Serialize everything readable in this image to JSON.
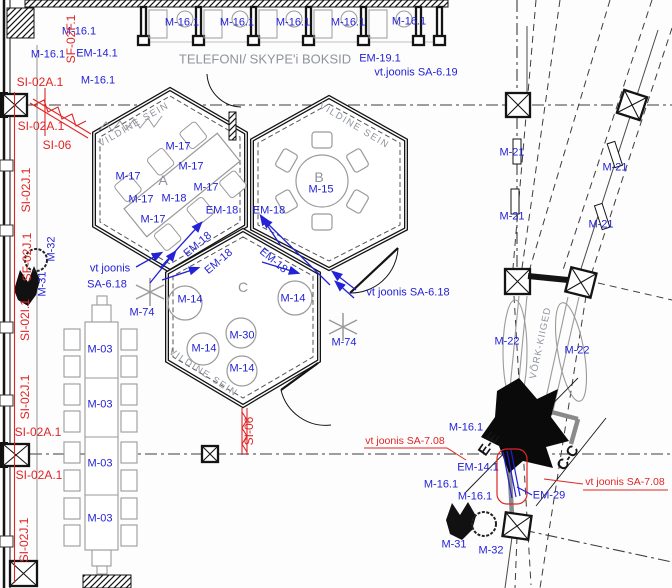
{
  "colors": {
    "blue": "#2322d6",
    "red": "#e02525",
    "gray": "#8e939c",
    "dark": "#141414"
  },
  "legend_refs": {
    "corridor_title": "TELEFONI/ SKYPE'i BOKSID",
    "see_drawing_619": "vt.joonis SA-6.19",
    "see_drawing_618": "vt joonis SA-6.18",
    "see_drawing_708": "vt joonis SA-7.08"
  },
  "labels": [
    {
      "t": "M-16.1",
      "x": 182,
      "y": 23,
      "n": "tag-booth-1"
    },
    {
      "t": "M-16.1",
      "x": 237,
      "y": 23,
      "n": "tag-booth-2"
    },
    {
      "t": "M-16.1",
      "x": 293,
      "y": 23,
      "n": "tag-booth-3"
    },
    {
      "t": "M-16.1",
      "x": 348,
      "y": 23,
      "n": "tag-booth-4"
    },
    {
      "t": "M-16.1",
      "x": 409,
      "y": 22,
      "n": "tag-booth-5"
    },
    {
      "t": "M-16.1",
      "x": 79,
      "y": 32,
      "n": "tag-m16"
    },
    {
      "t": "M-16.1",
      "x": 48,
      "y": 55,
      "n": "tag-m16"
    },
    {
      "t": "EM-14.1",
      "x": 97,
      "y": 54,
      "n": "tag-em14"
    },
    {
      "t": "M-16.1",
      "x": 98,
      "y": 81,
      "n": "tag-m16"
    },
    {
      "t": "TELEFONI/ SKYPE'i BOKSID",
      "x": 265,
      "y": 59,
      "c": "gray",
      "s": 13,
      "n": "corridor-title"
    },
    {
      "t": "EM-19.1",
      "x": 380,
      "y": 59,
      "n": "tag-em19"
    },
    {
      "t": "vt.joonis SA-6.19",
      "x": 416,
      "y": 73,
      "n": "ref-sa-6-19"
    },
    {
      "t": "VILDINE SEIN",
      "x": 134,
      "y": 125,
      "c": "gray",
      "s": 9.5,
      "r": -30,
      "ls": 1.5,
      "n": "felt-wall-a"
    },
    {
      "t": "VILDINE SEIN",
      "x": 354,
      "y": 126,
      "c": "gray",
      "s": 9.5,
      "r": 31,
      "ls": 1.5,
      "n": "felt-wall-b"
    },
    {
      "t": "M-17",
      "x": 178,
      "y": 147,
      "n": "tag-chair"
    },
    {
      "t": "M-17",
      "x": 191,
      "y": 167,
      "n": "tag-chair"
    },
    {
      "t": "M-17",
      "x": 128,
      "y": 177,
      "n": "tag-chair"
    },
    {
      "t": "M-17",
      "x": 206,
      "y": 188,
      "n": "tag-chair"
    },
    {
      "t": "M-17",
      "x": 141,
      "y": 200,
      "n": "tag-chair"
    },
    {
      "t": "M-17",
      "x": 153,
      "y": 220,
      "n": "tag-chair"
    },
    {
      "t": "M-18",
      "x": 174,
      "y": 199,
      "n": "tag-table-a"
    },
    {
      "t": "A",
      "x": 163,
      "y": 180,
      "c": "gray",
      "s": 14,
      "n": "room-a"
    },
    {
      "t": "B",
      "x": 319,
      "y": 177,
      "c": "gray",
      "s": 14,
      "n": "room-b"
    },
    {
      "t": "M-15",
      "x": 321,
      "y": 190,
      "n": "tag-table-b"
    },
    {
      "t": "EM-18",
      "x": 222,
      "y": 211,
      "n": "tag-em18"
    },
    {
      "t": "EM-18",
      "x": 269,
      "y": 211,
      "n": "tag-em18"
    },
    {
      "t": "EM-18",
      "x": 198,
      "y": 245,
      "r": -40,
      "n": "tag-em18"
    },
    {
      "t": "EM-18",
      "x": 219,
      "y": 262,
      "r": -40,
      "n": "tag-em18"
    },
    {
      "t": "EM-18",
      "x": 273,
      "y": 261,
      "r": 40,
      "n": "tag-em18"
    },
    {
      "t": "C",
      "x": 243,
      "y": 287,
      "c": "gray",
      "s": 14,
      "n": "room-c"
    },
    {
      "t": "M-14",
      "x": 190,
      "y": 300,
      "n": "tag-pouf"
    },
    {
      "t": "M-14",
      "x": 293,
      "y": 299,
      "n": "tag-pouf"
    },
    {
      "t": "M-14",
      "x": 204,
      "y": 349,
      "n": "tag-pouf"
    },
    {
      "t": "M-14",
      "x": 242,
      "y": 369,
      "n": "tag-pouf"
    },
    {
      "t": "M-30",
      "x": 242,
      "y": 336,
      "n": "tag-m30"
    },
    {
      "t": "M-74",
      "x": 142,
      "y": 313,
      "n": "tag-plant"
    },
    {
      "t": "M-74",
      "x": 344,
      "y": 343,
      "n": "tag-plant"
    },
    {
      "t": "VILDINE SEIN",
      "x": 203,
      "y": 373,
      "c": "gray",
      "s": 9.5,
      "r": 33,
      "ls": 1.5,
      "n": "felt-wall-c"
    },
    {
      "t": "vt joonis",
      "x": 110,
      "y": 269,
      "n": "ref-sa-6-18-line1"
    },
    {
      "t": "SA-6.18",
      "x": 107,
      "y": 285,
      "n": "ref-sa-6-18-line2"
    },
    {
      "t": "vt joonis SA-6.18",
      "x": 408,
      "y": 293,
      "n": "ref-sa-6-18-right"
    },
    {
      "t": "M-03",
      "x": 100,
      "y": 350,
      "n": "tag-table-left"
    },
    {
      "t": "M-03",
      "x": 100,
      "y": 405,
      "n": "tag-table-left"
    },
    {
      "t": "M-03",
      "x": 100,
      "y": 464,
      "n": "tag-table-left"
    },
    {
      "t": "M-03",
      "x": 100,
      "y": 519,
      "n": "tag-table-left"
    },
    {
      "t": "SF-02F.1",
      "x": 71,
      "y": 39,
      "c": "red",
      "r": -90,
      "s": 12,
      "n": "tag-sf02f"
    },
    {
      "t": "SI-02A.1",
      "x": 40,
      "y": 82,
      "c": "red",
      "s": 12,
      "n": "tag-si02a"
    },
    {
      "t": "SI-02A.1",
      "x": 41,
      "y": 126,
      "c": "red",
      "s": 12,
      "n": "tag-si02a"
    },
    {
      "t": "SI-06",
      "x": 57,
      "y": 145,
      "c": "red",
      "s": 12,
      "n": "tag-si06"
    },
    {
      "t": "SI-02J.1",
      "x": 26,
      "y": 190,
      "c": "red",
      "r": -90,
      "s": 12,
      "n": "tag-si02j"
    },
    {
      "t": "SF-02J.1",
      "x": 27,
      "y": 257,
      "c": "red",
      "r": -90,
      "s": 12,
      "n": "tag-sf02j"
    },
    {
      "t": "M-32",
      "x": 52,
      "y": 249,
      "r": -90,
      "n": "tag-plant-m32"
    },
    {
      "t": "M-31",
      "x": 43,
      "y": 284,
      "r": -90,
      "n": "tag-plant-m31"
    },
    {
      "t": "SI-02I.1",
      "x": 25,
      "y": 320,
      "c": "red",
      "r": -90,
      "s": 12,
      "n": "tag-si02i"
    },
    {
      "t": "SI-02J.1",
      "x": 25,
      "y": 397,
      "c": "red",
      "r": -90,
      "s": 12,
      "n": "tag-si02j"
    },
    {
      "t": "SI-02A.1",
      "x": 38,
      "y": 432,
      "c": "red",
      "s": 12,
      "n": "tag-si02a"
    },
    {
      "t": "SI-02A.1",
      "x": 39,
      "y": 475,
      "c": "red",
      "s": 12,
      "n": "tag-si02a"
    },
    {
      "t": "SI-02J.1",
      "x": 24,
      "y": 540,
      "c": "red",
      "r": -90,
      "s": 12,
      "n": "tag-si02j"
    },
    {
      "t": "SI-06",
      "x": 249,
      "y": 431,
      "c": "red",
      "r": -90,
      "s": 12,
      "n": "tag-si06-c"
    },
    {
      "t": "vt joonis SA-7.08",
      "x": 405,
      "y": 441,
      "c": "red",
      "s": 10.5,
      "n": "ref-sa-7-08-left"
    },
    {
      "t": "vt joonis SA-7.08",
      "x": 625,
      "y": 482,
      "c": "red",
      "s": 10.5,
      "n": "ref-sa-7-08-right"
    },
    {
      "t": "M-21",
      "x": 512,
      "y": 153,
      "n": "tag-m21"
    },
    {
      "t": "M-21",
      "x": 615,
      "y": 168,
      "n": "tag-m21"
    },
    {
      "t": "M-21",
      "x": 512,
      "y": 217,
      "n": "tag-m21"
    },
    {
      "t": "M-21",
      "x": 601,
      "y": 225,
      "n": "tag-m21"
    },
    {
      "t": "M-22",
      "x": 507,
      "y": 342,
      "n": "tag-swing"
    },
    {
      "t": "M-22",
      "x": 577,
      "y": 351,
      "n": "tag-swing"
    },
    {
      "t": "VÕRK-KIIGED",
      "x": 541,
      "y": 343,
      "c": "gray",
      "s": 9.5,
      "r": -78,
      "ls": 1,
      "n": "net-swings-title"
    },
    {
      "t": "M-16.1",
      "x": 466,
      "y": 428,
      "n": "tag-m16"
    },
    {
      "t": "EM-14.1",
      "x": 478,
      "y": 468,
      "n": "tag-em14"
    },
    {
      "t": "M-16.1",
      "x": 441,
      "y": 485,
      "n": "tag-m16"
    },
    {
      "t": "M-16.1",
      "x": 475,
      "y": 497,
      "n": "tag-m16"
    },
    {
      "t": "EM-29",
      "x": 549,
      "y": 496,
      "n": "tag-em29"
    },
    {
      "t": "E-E",
      "x": 489,
      "y": 444,
      "c": "dark",
      "r": -55,
      "s": 15,
      "b": 1,
      "n": "section-e-e"
    },
    {
      "t": "C-C",
      "x": 568,
      "y": 458,
      "c": "dark",
      "r": -55,
      "s": 15,
      "b": 1,
      "n": "section-c-c"
    },
    {
      "t": "M-31",
      "x": 454,
      "y": 545,
      "n": "tag-plant-m31"
    },
    {
      "t": "M-32",
      "x": 491,
      "y": 551,
      "n": "tag-plant-m32"
    }
  ]
}
